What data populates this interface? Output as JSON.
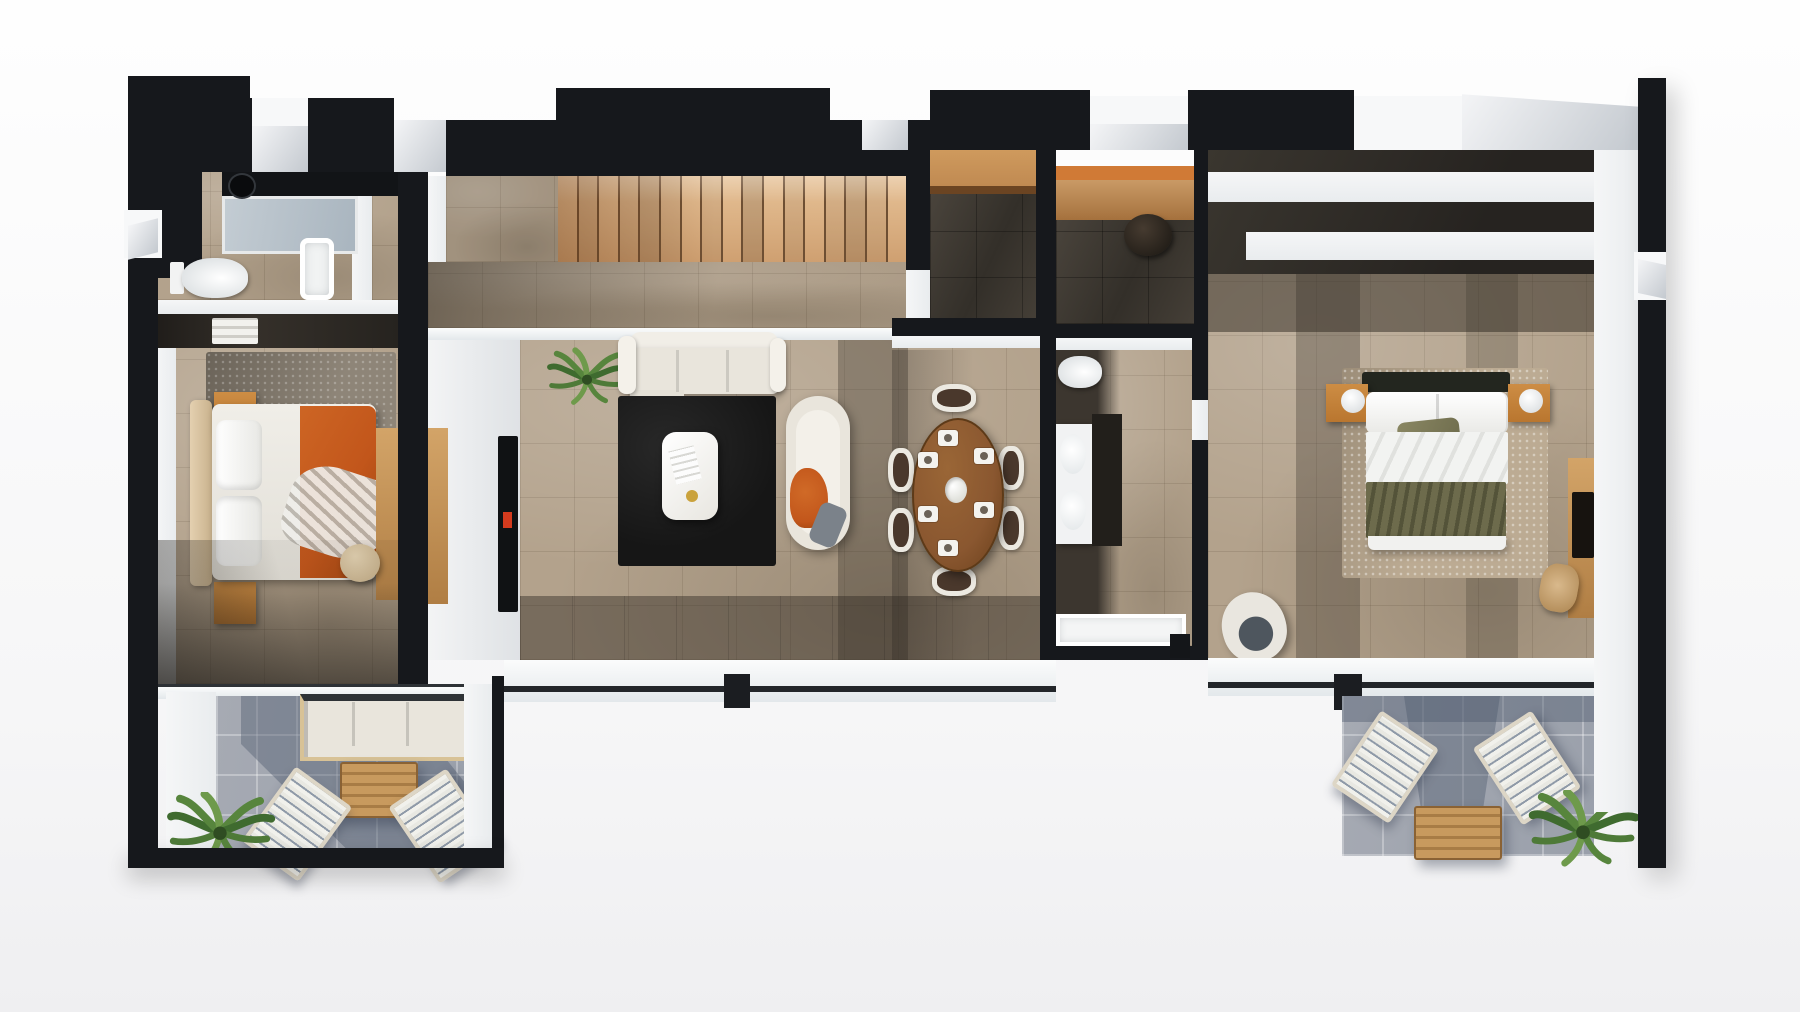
{
  "meta": {
    "type": "3d-floor-plan-render",
    "view": "top-down-axonometric",
    "visible_text": "none",
    "level": "apartment-upper-floor"
  },
  "palette": {
    "wall_black": "#16181c",
    "wall_dark": "#23262b",
    "inner_white": "#e9ecee",
    "exterior_white": "#fdfdfe",
    "glass_gray": "#ccd3d9",
    "floor_beige": "#b3a28c",
    "floor_dark": "#3c362f",
    "terrace_gray": "#9aa0ab",
    "terrace_shadow": "#4f5a6e",
    "stair_wood": "#d8ab7c",
    "counter_wood": "#c08a52",
    "desk_orange": "#d07a36",
    "table_wood": "#8a5730",
    "light_wood": "#b9762f",
    "accent_orange": "#c2561b",
    "olive_green": "#66644a",
    "sofa_white": "#e9e5dc",
    "rug_black": "#161616",
    "rug_gray": "#8e8578",
    "rug_speckle": "#bcab93",
    "plant_green": "#57853d",
    "tv_black": "#101214",
    "tv_accent_red": "#d43b1e"
  },
  "counts": {
    "stair_treads": 17,
    "dining_chairs": 6,
    "place_settings": 6,
    "sun_loungers_left_terrace": 2,
    "sun_loungers_right_terrace": 2,
    "bedrooms": 2,
    "bathrooms": 2,
    "terraces": 2
  },
  "rooms": [
    {
      "id": "bathroom-1",
      "name": "Bathroom 1",
      "furniture": [
        "walk-in-shower",
        "black-vanity-with-vessel-sink",
        "toilet",
        "bathtub"
      ]
    },
    {
      "id": "bedroom-1",
      "name": "Bedroom 1",
      "furniture": [
        "open-wardrobe",
        "double-bed-orange-blanket",
        "nightstand-top",
        "nightstand-bottom",
        "area-rug",
        "wood-sideboard",
        "round-pouf"
      ]
    },
    {
      "id": "terrace-1",
      "name": "Terrace 1",
      "furniture": [
        "outdoor-sofa",
        "slatted-coffee-table",
        "sun-lounger",
        "sun-lounger",
        "palm-plant"
      ]
    },
    {
      "id": "living-dining",
      "name": "Living / Dining Room",
      "furniture": [
        "staircase",
        "glass-balustrade",
        "tv-wall",
        "three-seat-sofa",
        "black-rug",
        "white-coffee-table",
        "lounge-daybed-orange-throw",
        "potted-plant",
        "oval-dining-table",
        "dining-chairs",
        "place-settings",
        "flower-centerpiece"
      ]
    },
    {
      "id": "hallway",
      "name": "Hallway / Study Nook",
      "furniture": [
        "built-in-counter",
        "built-in-desk",
        "stool"
      ]
    },
    {
      "id": "bathroom-2",
      "name": "Bathroom 2",
      "furniture": [
        "toilet",
        "double-vanity-two-sinks",
        "mirror-partition",
        "walk-in-shower"
      ]
    },
    {
      "id": "bedroom-2",
      "name": "Master Bedroom",
      "furniture": [
        "open-wardrobe-shelves",
        "double-bed-olive-blanket",
        "nightstand-with-lamp",
        "nightstand-with-lamp",
        "sparkle-rug",
        "armchair",
        "desk-with-tv",
        "desk-chair"
      ]
    },
    {
      "id": "terrace-2",
      "name": "Terrace 2",
      "furniture": [
        "sun-lounger",
        "sun-lounger",
        "slatted-coffee-table",
        "palm-plant"
      ]
    }
  ]
}
